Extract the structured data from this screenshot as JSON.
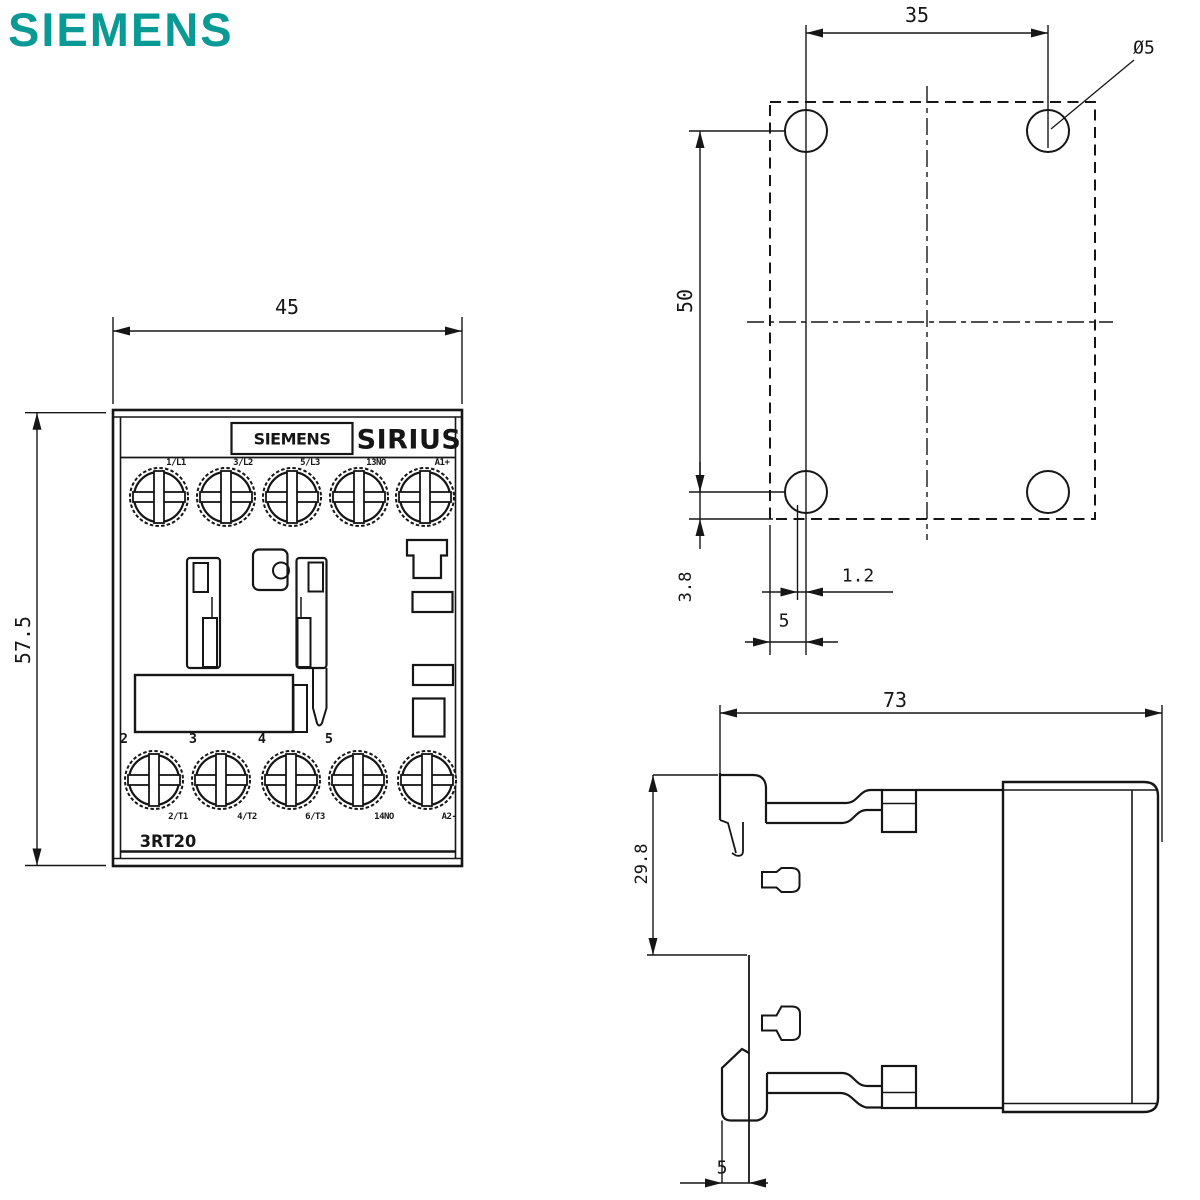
{
  "brand": {
    "logo_text": "SIEMENS",
    "logo_color": "#0a9a95"
  },
  "front_view": {
    "title": "front view",
    "dims": {
      "width": "45",
      "height": "57.5"
    },
    "brand_label": "SIEMENS",
    "series_label": "SIRIUS",
    "type_label": "3RT20",
    "terminals": {
      "top": [
        "1/L1",
        "3/L2",
        "5/L3",
        "13NO",
        "A1+"
      ],
      "bottom_numbers": [
        "2",
        "3",
        "4",
        "5"
      ],
      "bottom": [
        "2/T1",
        "4/T2",
        "6/T3",
        "14NO",
        "A2-"
      ]
    }
  },
  "drilling_view": {
    "title": "drilling pattern",
    "dims": {
      "hole_spacing_horizontal": "35",
      "hole_spacing_vertical": "50",
      "bottom_offset": "3.8",
      "rail_offset": "1.2",
      "rail_slot_width": "5",
      "hole_diameter": "Ø5"
    }
  },
  "side_view": {
    "title": "side view",
    "dims": {
      "depth": "73",
      "rail_clip_height": "29.8",
      "rail_depth": "5"
    }
  }
}
